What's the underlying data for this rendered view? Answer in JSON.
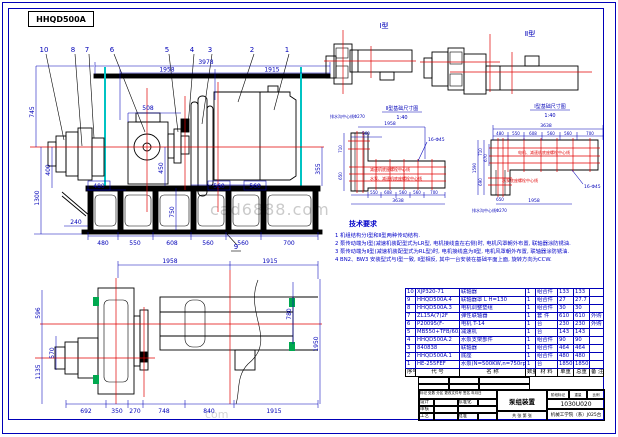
{
  "sheet": {
    "model_label": "HHQD500A",
    "watermark": "cad6888.com",
    "watermark2": "com"
  },
  "main_view": {
    "callouts_top": [
      "10",
      "8",
      "7",
      "6",
      "5",
      "4",
      "3",
      "2",
      "1"
    ],
    "callout_base": "9",
    "dims": {
      "overall": "3978",
      "left_span": "1958",
      "right_span": "1915",
      "coupling": "508",
      "left_745": "745",
      "left_400": "400",
      "left_1300": "1300",
      "right_355": "355",
      "mid_480": "480",
      "mid_450": "450",
      "mid_750": "750",
      "mid_560a": "560",
      "mid_560b": "560",
      "bot_240": "240",
      "bot_480": "480",
      "bot_550": "550",
      "bot_608": "608",
      "bot_560a": "560",
      "bot_560b": "560",
      "bot_700": "700"
    }
  },
  "plan_view": {
    "dims": {
      "top_1958": "1958",
      "top_1915": "1915",
      "right_780": "780",
      "right_1950": "1950",
      "left_596": "596",
      "left_570": "570",
      "left_1135": "1135",
      "bot_692": "692",
      "bot_350": "350",
      "bot_270": "270",
      "bot_748": "748",
      "bot_840": "840",
      "bot_1915": "1915"
    }
  },
  "detail_views": {
    "type1_label": "Ⅰ型",
    "type2_label": "Ⅱ型"
  },
  "foundation_left": {
    "title": "Ⅱ型基础尺寸图",
    "scale": "1:40",
    "bolt_note": "16-Φ45",
    "drain_note": "排水沟中心线Φ270",
    "red_line1": "减速机底座螺栓中心线",
    "red_line2": "水泵、减速机底座螺栓中心线",
    "dims": {
      "top_1958": "1958",
      "top_560": "560",
      "left_710": "710",
      "left_650": "650",
      "bot_550": "550",
      "bot_608": "608",
      "bot_560a": "560",
      "bot_560b": "560",
      "bot_700": "700",
      "total": "3638"
    }
  },
  "foundation_right": {
    "title": "Ⅰ型基础尺寸图",
    "scale": "1:40",
    "bolt_note": "16-Φ45",
    "drain_note": "排水沟中心线Φ270",
    "red_line1": "电机、减速机底座螺栓中心线",
    "red_line2": "水泵底座螺栓中心线",
    "dims": {
      "total": "3638",
      "seg_480": "480",
      "seg_550": "550",
      "seg_608": "608",
      "seg_560a": "560",
      "seg_560b": "560",
      "seg_700": "700",
      "left_1590": "1590",
      "left_710": "710",
      "left_670": "670",
      "left_690": "690",
      "bot_650": "650",
      "bot_1958": "1958"
    }
  },
  "tech_req": {
    "title": "技术要求",
    "lines": [
      "1 机组结构分Ⅰ型和Ⅱ型两种传动结构.",
      "2 泵传动端为Ⅰ型(减速机装配型式为LR型, 电机接线盒在右侧)时, 电机风罩朝外布置, 联轴器涂防锈油.",
      "3 泵传动端为Ⅱ型(减速机装配型式为RL型)时, 电机接线盒为Ⅱ型, 电机风罩朝外布置, 联轴器涂防锈油.",
      "4 BN2、BW3 安装型式与Ⅰ型一致, Ⅱ型相反, 其中一台安装在基础平面上面, 旋转方向为CCW."
    ]
  },
  "bom": {
    "headers": [
      "序号",
      "代  号",
      "名  称",
      "数量",
      "材 料",
      "单重",
      "总重",
      "备 注"
    ],
    "rows": [
      [
        "10",
        "XJP320-71",
        "联轴器",
        "1",
        "组合件",
        "133",
        "133",
        ""
      ],
      [
        "9",
        "HHQD500A.4",
        "联轴器罩 L H=130",
        "1",
        "组合件",
        "27",
        "27.7",
        ""
      ],
      [
        "8",
        "HHQD500A.3",
        "电机调整垫组",
        "1",
        "组合件",
        "30",
        "30",
        ""
      ],
      [
        "7",
        "ZL15A(7)2F",
        "弹性联轴器",
        "1",
        "套 件",
        "610",
        "610",
        "外购"
      ],
      [
        "6",
        "P20095(F-",
        "电机 T-14",
        "1",
        "台",
        "230",
        "230",
        "外购"
      ],
      [
        "5",
        "MB550+TFB/60.2",
        "减速机",
        "1",
        "台",
        "143",
        "143",
        ""
      ],
      [
        "4",
        "HHQD500A.2",
        "水泵支架部件",
        "1",
        "组合件",
        "90",
        "90",
        ""
      ],
      [
        "3",
        "840838",
        "联轴器",
        "1",
        "组合件",
        "464",
        "464",
        ""
      ],
      [
        "2",
        "HHQD500A.1",
        "底座",
        "1",
        "组合件",
        "480",
        "480",
        ""
      ],
      [
        "1",
        "HE-255FEF",
        "水泵(N=500KW,n=750rpm)",
        "1",
        "台",
        "1850",
        "1850",
        ""
      ]
    ]
  },
  "title_block": {
    "drawing_title": "泵组装置",
    "drawing_number": "1030U020",
    "company": "机械工学院（系）J025台",
    "labels": {
      "mark": "标记",
      "count": "处数",
      "zone": "分区",
      "doc": "更改文件号",
      "sign": "签名",
      "date": "年月日",
      "design": "设计",
      "check": "审核",
      "process": "工艺",
      "standard": "标准化",
      "approve": "批准",
      "stage": "阶段标记",
      "weight": "重量",
      "scale": "比例",
      "sheet_total": "共 张",
      "sheet_no": "第 张"
    }
  }
}
